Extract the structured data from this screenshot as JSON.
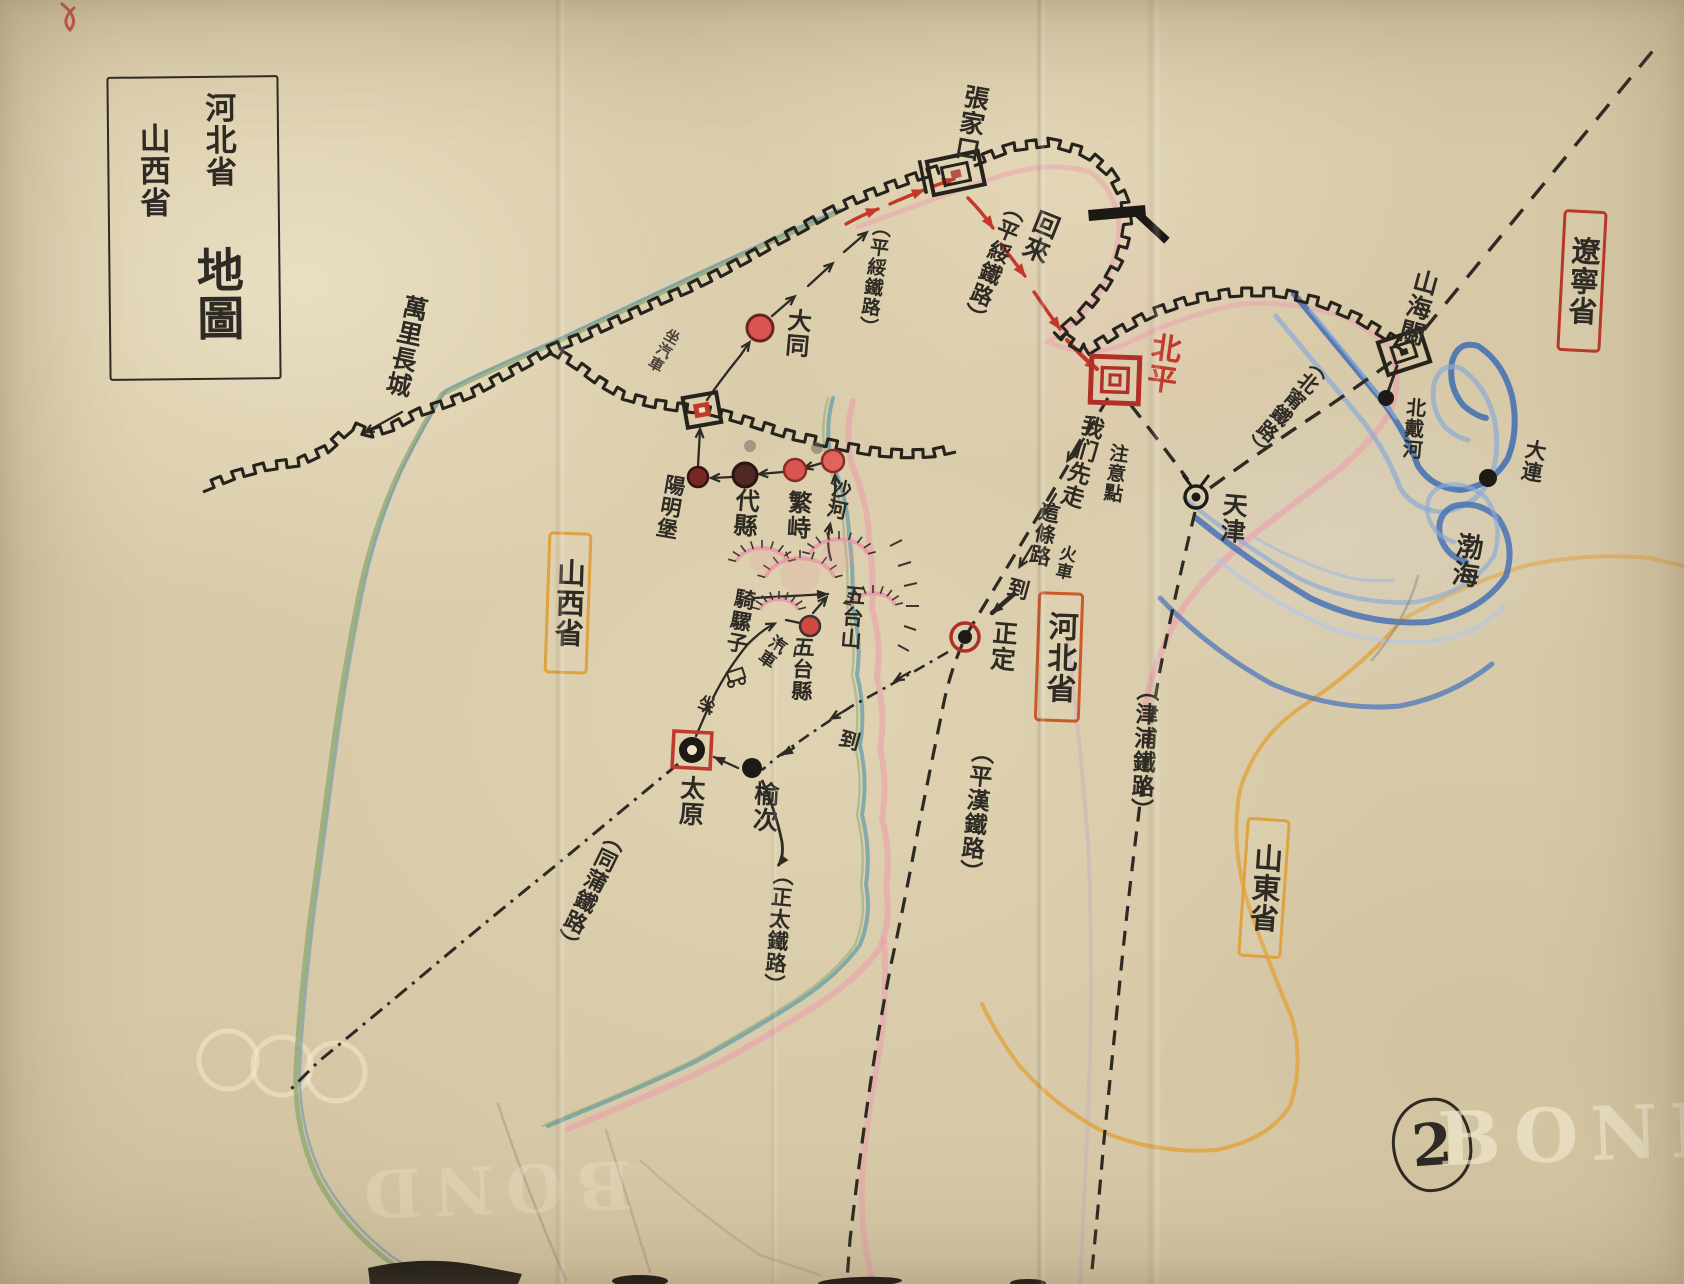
{
  "map": {
    "title_box": {
      "region1": "河北省",
      "region2": "山西省",
      "word": "地圖"
    },
    "page_number": "2",
    "watermark": "BOND",
    "great_wall_label": "萬里長城",
    "sea_label": "渤海",
    "mountain_label": "五台山",
    "provinces": {
      "shanxi": "山西省",
      "hebei": "河北省",
      "shandong": "山東省",
      "liaoning": "遼寧省"
    },
    "cities": {
      "zhangjiakou": "張家口",
      "beiping": "北平",
      "tianjin": "天津",
      "shanhaiguan": "山海關",
      "beidaihe": "北戴河",
      "dalian": "大連",
      "datong": "大同",
      "yangmingbu": "陽明堡",
      "daixian": "代縣",
      "fanshi": "繁峙",
      "shahe": "沙河",
      "wutai_county": "五台縣",
      "taiyuan": "太原",
      "yuci": "榆次",
      "zhengding": "正定"
    },
    "railways": {
      "pingsui_return": "（平綏鐵路）",
      "pingsui": "（平綏鐵路）",
      "beining": "（北甯鐵路）",
      "jinpu": "（津浦鐵路）",
      "pinghan": "（平漢鐵路）",
      "zhengtai": "（正太鐵路）",
      "tongpu": "（同蒲鐵路）"
    },
    "route_notes": {
      "return_trip": "回來",
      "we_go_first": "我们先走",
      "attention": "注意點",
      "this_road": "這條路",
      "by_train": "火車",
      "arrive_a": "到",
      "arrive_b": "到",
      "sit": "坐",
      "bus": "汽車",
      "by_bus": "坐汽車",
      "ride_mule": "騎騾子"
    },
    "colors": {
      "ink": "#2e2a24",
      "red_ink": "#c2392b",
      "orange_box": "#e0a23f",
      "red_box": "#b8392a",
      "hebei_box": "#cc5a28",
      "sea_blue": "#3f6db5",
      "river_teal": "#6aa0a8",
      "river_green": "#86a56b",
      "pink_border": "#eb9fae",
      "paper": "#d7c9a7"
    }
  }
}
